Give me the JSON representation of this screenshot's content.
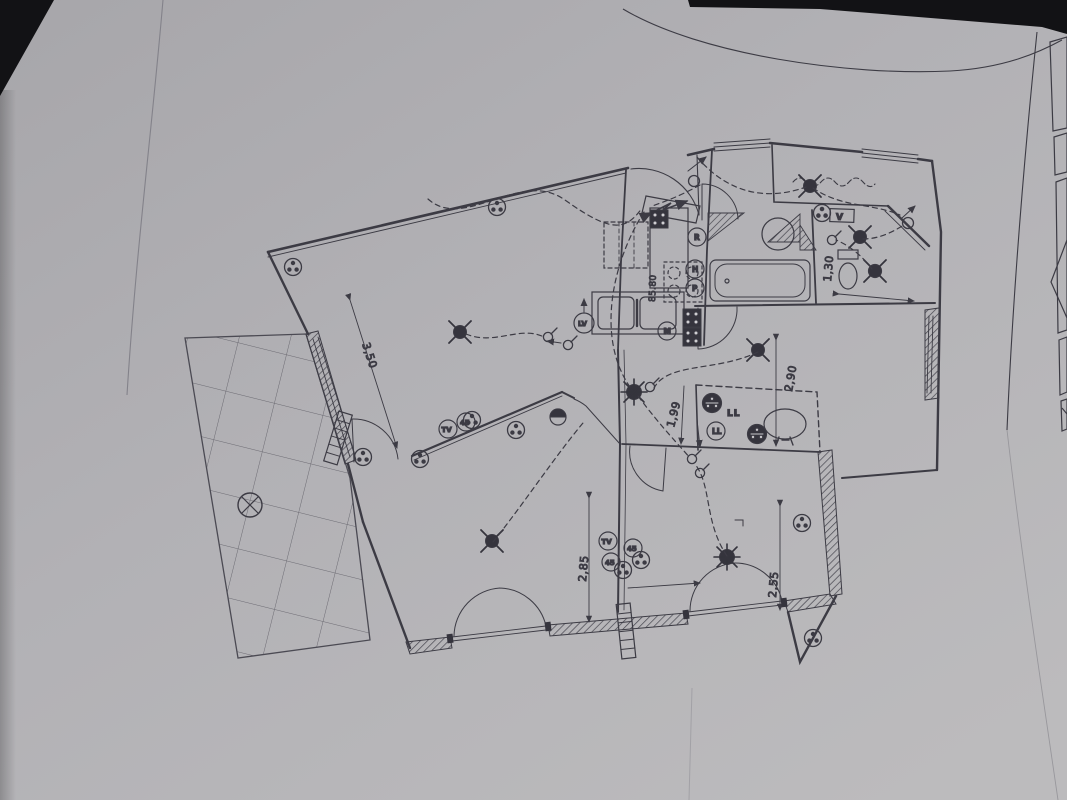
{
  "photo": {
    "paper_color": "#b2b1b5",
    "ink_color": "#3c3b44",
    "background_color": "#0e0e11"
  },
  "plan": {
    "dimensions": {
      "living_wall": "3,50",
      "bedroom1": "2,90",
      "hall": "1,99",
      "bedroom3": "2,85",
      "bedroom2": "2,55",
      "wc": "1,30",
      "kitchen_counter": "85.80"
    },
    "appliance_labels": {
      "r": "R",
      "h": "H",
      "p": "P",
      "m": "M",
      "lv": "LV",
      "ll": "LL",
      "v": "V"
    },
    "outlet_labels": {
      "tv": "TV",
      "amp45": "45"
    }
  }
}
